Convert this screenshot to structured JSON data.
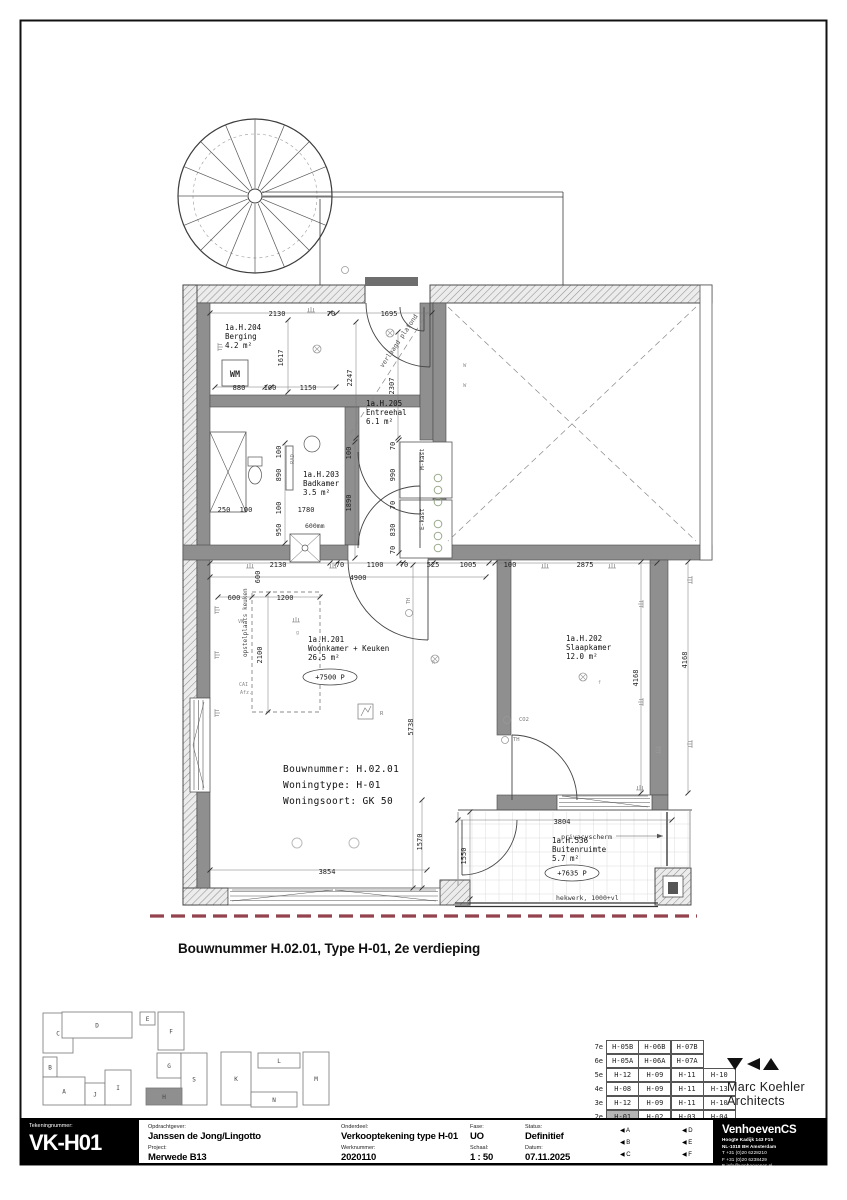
{
  "page": {
    "caption": "Bouwnummer H.02.01, Type H-01, 2e verdieping"
  },
  "colors": {
    "wall_gray": "#8f8f8f",
    "property_line_red": "#93424e",
    "table_highlight": "#b5b5b5"
  },
  "plan": {
    "rooms": [
      {
        "id": "1a.H.204",
        "name": "Berging",
        "area": "4.2 m²",
        "x": 225,
        "y": 330
      },
      {
        "id": "1a.H.205",
        "name": "Entreehal",
        "area": "6.1 m²",
        "x": 366,
        "y": 406
      },
      {
        "id": "1a.H.203",
        "name": "Badkamer",
        "area": "3.5 m²",
        "x": 303,
        "y": 477
      },
      {
        "id": "1a.H.201",
        "name": "Woonkamer + Keuken",
        "area": "26.5 m²",
        "x": 308,
        "y": 642,
        "level": {
          "t": "+7500 P",
          "x": 330,
          "y": 677
        }
      },
      {
        "id": "1a.H.202",
        "name": "Slaapkamer",
        "area": "12.0 m²",
        "x": 566,
        "y": 641
      },
      {
        "id": "1a.H.536",
        "name": "Buitenruimte",
        "area": "5.7 m²",
        "x": 552,
        "y": 843,
        "level": {
          "t": "+7635 P",
          "x": 572,
          "y": 873
        }
      }
    ],
    "info": {
      "lines": [
        "Bouwnummer: H.02.01",
        "Woningtype:  H-01",
        "Woningsoort: GK 50"
      ]
    },
    "dims": [
      {
        "t": "2130",
        "x": 277,
        "y": 316
      },
      {
        "t": "70",
        "x": 331,
        "y": 316
      },
      {
        "t": "1695",
        "x": 389,
        "y": 316
      },
      {
        "t": "1617",
        "x": 283,
        "y": 358,
        "r": -90
      },
      {
        "t": "2247",
        "x": 352,
        "y": 378,
        "r": -90
      },
      {
        "t": "2307",
        "x": 394,
        "y": 386,
        "r": -90
      },
      {
        "t": "880",
        "x": 239,
        "y": 390
      },
      {
        "t": "100",
        "x": 270,
        "y": 390
      },
      {
        "t": "1150",
        "x": 308,
        "y": 390
      },
      {
        "t": "100",
        "x": 281,
        "y": 452,
        "r": -90
      },
      {
        "t": "890",
        "x": 281,
        "y": 475,
        "r": -90
      },
      {
        "t": "100",
        "x": 281,
        "y": 508,
        "r": -90
      },
      {
        "t": "950",
        "x": 281,
        "y": 530,
        "r": -90
      },
      {
        "t": "250",
        "x": 224,
        "y": 512
      },
      {
        "t": "100",
        "x": 246,
        "y": 512
      },
      {
        "t": "1780",
        "x": 306,
        "y": 512
      },
      {
        "t": "100",
        "x": 351,
        "y": 453,
        "r": -90
      },
      {
        "t": "1890",
        "x": 351,
        "y": 503,
        "r": -90
      },
      {
        "t": "70",
        "x": 395,
        "y": 446,
        "r": -90
      },
      {
        "t": "990",
        "x": 395,
        "y": 475,
        "r": -90
      },
      {
        "t": "70",
        "x": 395,
        "y": 505,
        "r": -90
      },
      {
        "t": "830",
        "x": 395,
        "y": 530,
        "r": -90
      },
      {
        "t": "70",
        "x": 395,
        "y": 550,
        "r": -90
      },
      {
        "t": "2130",
        "x": 278,
        "y": 567
      },
      {
        "t": "70",
        "x": 340,
        "y": 567
      },
      {
        "t": "1100",
        "x": 375,
        "y": 567
      },
      {
        "t": "70",
        "x": 404,
        "y": 567
      },
      {
        "t": "525",
        "x": 433,
        "y": 567
      },
      {
        "t": "1005",
        "x": 468,
        "y": 567
      },
      {
        "t": "100",
        "x": 510,
        "y": 567
      },
      {
        "t": "2875",
        "x": 585,
        "y": 567
      },
      {
        "t": "4900",
        "x": 358,
        "y": 580
      },
      {
        "t": "600",
        "x": 260,
        "y": 577,
        "r": -90
      },
      {
        "t": "600",
        "x": 234,
        "y": 600
      },
      {
        "t": "1200",
        "x": 285,
        "y": 600
      },
      {
        "t": "2100",
        "x": 262,
        "y": 655,
        "r": -90
      },
      {
        "t": "5738",
        "x": 413,
        "y": 727,
        "r": -90
      },
      {
        "t": "1570",
        "x": 422,
        "y": 842,
        "r": -90
      },
      {
        "t": "3854",
        "x": 327,
        "y": 874
      },
      {
        "t": "1550",
        "x": 466,
        "y": 856,
        "r": -90
      },
      {
        "t": "3804",
        "x": 562,
        "y": 824
      },
      {
        "t": "4168",
        "x": 638,
        "y": 678,
        "r": -90
      },
      {
        "t": "4168",
        "x": 687,
        "y": 660,
        "r": -90
      }
    ],
    "notes": [
      {
        "t": "WM",
        "x": 235,
        "y": 377,
        "s": 8.5,
        "w": 700,
        "a": "middle"
      },
      {
        "t": "verlaagd plafond",
        "x": 383,
        "y": 368,
        "r": -56,
        "s": 6.5,
        "c": "#555"
      },
      {
        "t": "M-kast",
        "x": 424,
        "y": 470,
        "r": -90,
        "s": 6
      },
      {
        "t": "E-kast",
        "x": 424,
        "y": 530,
        "r": -90,
        "s": 6
      },
      {
        "t": "RAD",
        "x": 294,
        "y": 464,
        "r": -90,
        "s": 5.5,
        "c": "#888"
      },
      {
        "t": "600mm",
        "x": 305,
        "y": 528,
        "s": 6.5
      },
      {
        "t": "opstelplaats keuken",
        "x": 247,
        "y": 657,
        "r": -90,
        "s": 6,
        "c": "#444"
      },
      {
        "t": "VW",
        "x": 238,
        "y": 623,
        "s": 5,
        "c": "#888"
      },
      {
        "t": "CAI",
        "x": 239,
        "y": 686,
        "s": 5,
        "c": "#888"
      },
      {
        "t": "Afz.",
        "x": 240,
        "y": 694,
        "s": 5,
        "c": "#888"
      },
      {
        "t": "TH",
        "x": 410,
        "y": 604,
        "r": -90,
        "s": 5,
        "c": "#777"
      },
      {
        "t": "CO2",
        "x": 519,
        "y": 721,
        "s": 5.5,
        "c": "#777"
      },
      {
        "t": "TH",
        "x": 513,
        "y": 741,
        "s": 5.5,
        "c": "#777"
      },
      {
        "t": "W",
        "x": 463,
        "y": 367,
        "s": 5.5,
        "c": "#999"
      },
      {
        "t": "W",
        "x": 463,
        "y": 387,
        "s": 5.5,
        "c": "#999"
      },
      {
        "t": "R",
        "x": 380,
        "y": 715,
        "s": 5.5,
        "c": "#777"
      },
      {
        "t": "g",
        "x": 296,
        "y": 634,
        "s": 5,
        "c": "#999"
      },
      {
        "t": "f",
        "x": 598,
        "y": 684,
        "s": 5,
        "c": "#999"
      },
      {
        "t": "h",
        "x": 432,
        "y": 664,
        "s": 5,
        "c": "#999"
      },
      {
        "t": "privacyscherm",
        "x": 612,
        "y": 839,
        "s": 6.5,
        "a": "end"
      },
      {
        "t": "hekwerk, 1000+vl",
        "x": 556,
        "y": 900,
        "s": 6.5
      }
    ],
    "symbols": [
      {
        "k": "socket",
        "x": 215,
        "y": 610,
        "r": 90
      },
      {
        "k": "socket",
        "x": 215,
        "y": 655,
        "r": 90
      },
      {
        "k": "socket",
        "x": 215,
        "y": 713,
        "r": 90
      },
      {
        "k": "socket",
        "x": 250,
        "y": 568
      },
      {
        "k": "socket",
        "x": 333,
        "y": 568
      },
      {
        "k": "socket",
        "x": 545,
        "y": 568
      },
      {
        "k": "socket",
        "x": 612,
        "y": 568
      },
      {
        "k": "socket",
        "x": 296,
        "y": 622
      },
      {
        "k": "socket",
        "x": 643,
        "y": 604,
        "r": -90
      },
      {
        "k": "socket",
        "x": 643,
        "y": 702,
        "r": -90
      },
      {
        "k": "socket",
        "x": 660,
        "y": 750,
        "r": -90
      },
      {
        "k": "socket",
        "x": 692,
        "y": 580,
        "r": -90
      },
      {
        "k": "socket",
        "x": 692,
        "y": 744,
        "r": -90
      },
      {
        "k": "socket",
        "x": 640,
        "y": 790
      },
      {
        "k": "socket",
        "x": 218,
        "y": 347,
        "r": 90
      },
      {
        "k": "socket",
        "x": 311,
        "y": 312
      },
      {
        "k": "light",
        "x": 390,
        "y": 333
      },
      {
        "k": "light",
        "x": 435,
        "y": 659
      },
      {
        "k": "light",
        "x": 583,
        "y": 677
      },
      {
        "k": "light",
        "x": 317,
        "y": 349
      },
      {
        "k": "circ",
        "x": 297,
        "y": 843
      },
      {
        "k": "circ",
        "x": 354,
        "y": 843
      },
      {
        "k": "dot",
        "x": 438,
        "y": 478
      },
      {
        "k": "dot",
        "x": 438,
        "y": 490
      },
      {
        "k": "dot",
        "x": 438,
        "y": 502
      },
      {
        "k": "dot",
        "x": 438,
        "y": 524
      },
      {
        "k": "dot",
        "x": 438,
        "y": 536
      },
      {
        "k": "dot",
        "x": 438,
        "y": 548
      },
      {
        "k": "circ3",
        "x": 409,
        "y": 613
      },
      {
        "k": "circ3",
        "x": 507,
        "y": 720
      },
      {
        "k": "circ3",
        "x": 505,
        "y": 740
      },
      {
        "k": "circ3",
        "x": 345,
        "y": 270
      }
    ]
  },
  "keyplan": {
    "buildings": [
      {
        "label": "C",
        "x": 43,
        "y": 1013,
        "w": 30,
        "h": 40
      },
      {
        "label": "D",
        "x": 62,
        "y": 1012,
        "w": 70,
        "h": 26
      },
      {
        "label": "B",
        "x": 43,
        "y": 1057,
        "w": 14,
        "h": 20
      },
      {
        "label": "A",
        "x": 43,
        "y": 1077,
        "w": 42,
        "h": 28
      },
      {
        "label": "J",
        "x": 85,
        "y": 1083,
        "w": 20,
        "h": 22
      },
      {
        "label": "I",
        "x": 105,
        "y": 1070,
        "w": 26,
        "h": 35
      },
      {
        "label": "E",
        "x": 140,
        "y": 1012,
        "w": 15,
        "h": 13
      },
      {
        "label": "F",
        "x": 158,
        "y": 1012,
        "w": 26,
        "h": 38
      },
      {
        "label": "G",
        "x": 157,
        "y": 1053,
        "w": 24,
        "h": 25
      },
      {
        "label": "S",
        "x": 181,
        "y": 1053,
        "w": 26,
        "h": 52
      },
      {
        "label": "H",
        "x": 146,
        "y": 1088,
        "w": 36,
        "h": 17,
        "hl": true
      },
      {
        "label": "K",
        "x": 221,
        "y": 1052,
        "w": 30,
        "h": 53
      },
      {
        "label": "L",
        "x": 258,
        "y": 1053,
        "w": 42,
        "h": 15
      },
      {
        "label": "N",
        "x": 251,
        "y": 1092,
        "w": 46,
        "h": 15
      },
      {
        "label": "M",
        "x": 303,
        "y": 1052,
        "w": 26,
        "h": 53
      }
    ]
  },
  "floor_table": {
    "rows": [
      {
        "floor": "7e",
        "cells": [
          "H-05B",
          "H-06B",
          "H-07B"
        ]
      },
      {
        "floor": "6e",
        "cells": [
          "H-05A",
          "H-06A",
          "H-07A"
        ]
      },
      {
        "floor": "5e",
        "cells": [
          "H-12",
          "H-09",
          "H-11",
          "H-10"
        ]
      },
      {
        "floor": "4e",
        "cells": [
          "H-08",
          "H-09",
          "H-11",
          "H-13"
        ]
      },
      {
        "floor": "3e",
        "cells": [
          "H-12",
          "H-09",
          "H-11",
          "H-10"
        ]
      },
      {
        "floor": "2e",
        "cells": [
          "H-01",
          "H-02",
          "H-03",
          "H-04"
        ],
        "highlight": 0
      }
    ]
  },
  "title_block": {
    "tekeningnummer_label": "Tekeningnummer:",
    "tekeningnummer": "VK-H01",
    "cols": [
      {
        "top": {
          "label": "Opdrachtgever:",
          "value": "Janssen de Jong/Lingotto"
        },
        "bottom": {
          "label": "Project:",
          "value": "Merwede B13"
        }
      },
      {
        "top": {
          "label": "Onderdeel:",
          "value": "Verkooptekening type H-01"
        },
        "bottom": {
          "label": "Werknummer:",
          "value": "2020110"
        }
      },
      {
        "top": {
          "label": "Fase:",
          "value": "UO"
        },
        "bottom": {
          "label": "Schaal:",
          "value": "1 : 50"
        }
      },
      {
        "top": {
          "label": "Status:",
          "value": "Definitief"
        },
        "bottom": {
          "label": "Datum:",
          "value": "07.11.2025"
        }
      }
    ],
    "markers": {
      "col1": [
        "A",
        "B",
        "C"
      ],
      "col2": [
        "D",
        "E",
        "F"
      ]
    }
  },
  "logos": {
    "mka": {
      "line1": "Marc Koehler",
      "line2": "Architects"
    },
    "vcs": {
      "name": "VenhoevenCS",
      "lines": [
        "Hoogte Kadijk 143 F15",
        "NL-1018 BH Amsterdam",
        "T +31 (0)20 6228210",
        "F +31 (0)20 6238429",
        "E info@venhoevencs.nl"
      ]
    }
  }
}
